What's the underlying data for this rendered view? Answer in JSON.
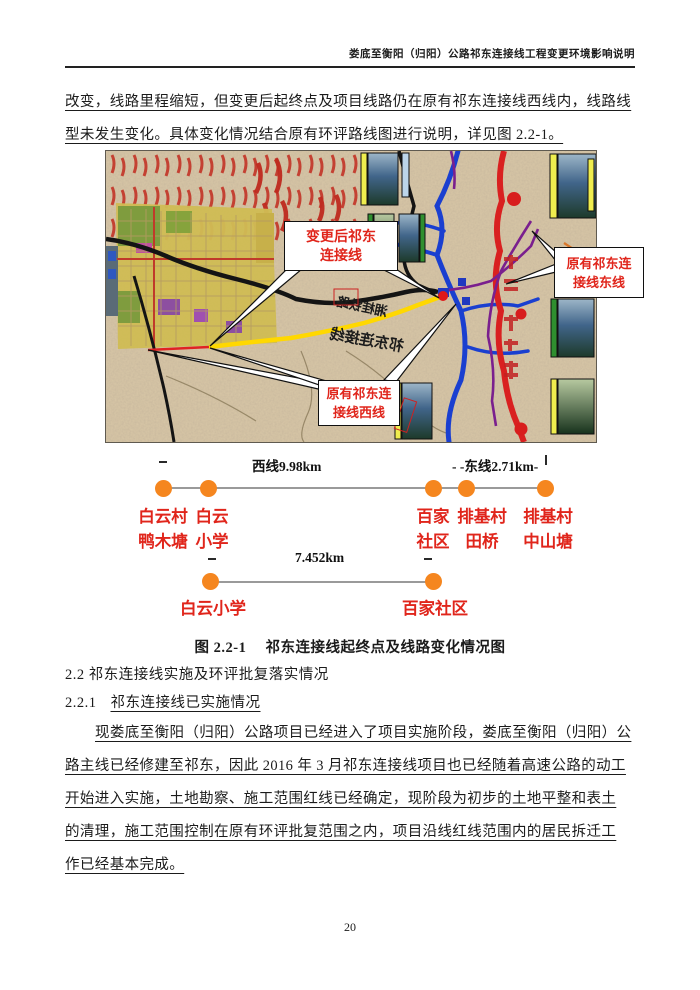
{
  "header": {
    "title": "娄底至衡阳（归阳）公路祁东连接线工程变更环境影响说明"
  },
  "paragraphs": {
    "p1": {
      "lines": [
        "改变，线路里程缩短，但变更后起终点及项目线路仍在原有祁东连接线西线内，线路线",
        "型未发生变化。具体变化情况结合原有环评路线图进行说明，详见图 2.2-1。"
      ]
    },
    "p2": {
      "lines": [
        "现娄底至衡阳（归阳）公路项目已经进入了项目实施阶段，娄底至衡阳（归阳）公",
        "路主线已经修建至祁东，因此 2016 年 3 月祁东连接线项目也已经随着高速公路的动工",
        "开始进入实施，土地勘察、施工范围红线已经确定，现阶段为初步的土地平整和表土",
        "的清理，施工范围控制在原有环评批复范围之内，项目沿线红线范围内的居民拆迁工",
        "作已经基本完成。"
      ]
    }
  },
  "figure": {
    "caption": "图 2.2-1　 祁东连接线起终点及线路变化情况图",
    "map": {
      "callouts": {
        "changed": {
          "l1": "变更后祁东",
          "l2": "连接线"
        },
        "west": {
          "l1": "原有祁东连",
          "l2": "接线西线"
        },
        "east": {
          "l1": "原有祁东连",
          "l2": "接线东线"
        }
      },
      "road_labels": {
        "railway": "湘桂铁路",
        "connector": "祁东连接线"
      }
    },
    "diagram1": {
      "west_len": "西线9.98km",
      "east_len": "- -东线2.71km-",
      "stations": [
        {
          "l1": "白云村",
          "l2": "鸭木塘"
        },
        {
          "l1": "白云",
          "l2": "小学"
        },
        {
          "l1": "百家",
          "l2": "社区"
        },
        {
          "l1": "排基村",
          "l2": "田桥"
        },
        {
          "l1": "排基村",
          "l2": "中山塘"
        }
      ]
    },
    "diagram2": {
      "len": "7.452km",
      "stations": [
        {
          "name": "白云小学"
        },
        {
          "name": "百家社区"
        }
      ]
    }
  },
  "sections": {
    "s22": "2.2 祁东连接线实施及环评批复落实情况",
    "s221_num": "2.2.1",
    "s221_title": "祁东连接线已实施情况"
  },
  "page": {
    "number": "20"
  },
  "colors": {
    "accent_red": "#e0251b",
    "dot_orange": "#f5861f",
    "route_yellow": "#ffd800"
  }
}
